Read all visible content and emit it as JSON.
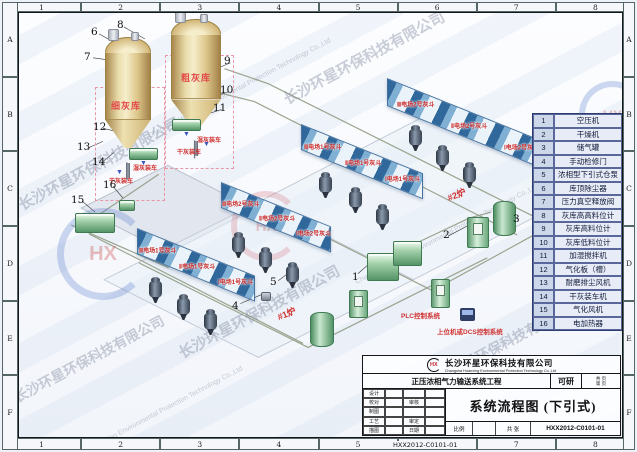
{
  "frame": {
    "top": [
      "1",
      "2",
      "3",
      "4",
      "5",
      "6",
      "7",
      "8"
    ],
    "bottom": [
      "1",
      "2",
      "3",
      "4",
      "5",
      "6",
      "7",
      "8"
    ],
    "left": [
      "A",
      "B",
      "C",
      "D",
      "E",
      "F"
    ],
    "right": [
      "A",
      "B",
      "C",
      "D",
      "E",
      "F"
    ]
  },
  "watermarks": {
    "company_cn": "长沙环星环保科技有限公司",
    "company_en": "Changsha Huanxing Environmental Protection Technology Co.,Ltd",
    "logo_text": "HX"
  },
  "plant": {
    "silo_fine": "细灰库",
    "silo_coarse": "粗灰库",
    "wet_loading": "湿灰装车",
    "dry_loading": "干灰装车",
    "boiler1": "#1炉",
    "boiler2": "#2炉",
    "plc": "PLC控制系统",
    "dcs": "上位机或DCS控制系统",
    "hopper_groups": [
      {
        "labels": [
          "Ⅲ电场2号灰斗",
          "Ⅱ电场2号灰斗",
          "Ⅰ电场2号灰斗"
        ]
      },
      {
        "labels": [
          "Ⅲ电场1号灰斗",
          "Ⅱ电场1号灰斗",
          "Ⅰ电场1号灰斗"
        ]
      },
      {
        "labels": [
          "Ⅲ电场2号灰斗",
          "Ⅱ电场2号灰斗",
          "Ⅰ电场2号灰斗"
        ]
      },
      {
        "labels": [
          "Ⅲ电场1号灰斗",
          "Ⅱ电场1号灰斗",
          "Ⅰ电场1号灰斗"
        ]
      }
    ],
    "callouts": [
      "1",
      "2",
      "3",
      "4",
      "5",
      "6",
      "7",
      "8",
      "9",
      "10",
      "11",
      "12",
      "13",
      "14",
      "15",
      "16"
    ]
  },
  "legend": {
    "rows": [
      {
        "no": "1",
        "name": "空压机"
      },
      {
        "no": "2",
        "name": "干燥机"
      },
      {
        "no": "3",
        "name": "储气罐"
      },
      {
        "no": "4",
        "name": "手动检修门"
      },
      {
        "no": "5",
        "name": "浓相型下引式仓泵"
      },
      {
        "no": "6",
        "name": "库顶除尘器"
      },
      {
        "no": "7",
        "name": "压力真空释放阀"
      },
      {
        "no": "8",
        "name": "灰库高高料位计"
      },
      {
        "no": "9",
        "name": "灰库高料位计"
      },
      {
        "no": "10",
        "name": "灰库低料位计"
      },
      {
        "no": "11",
        "name": "加湿搅拌机"
      },
      {
        "no": "12",
        "name": "气化板（槽）"
      },
      {
        "no": "13",
        "name": "耐磨排尘风机"
      },
      {
        "no": "14",
        "name": "干灰装车机"
      },
      {
        "no": "15",
        "name": "气化风机"
      },
      {
        "no": "16",
        "name": "电加热器"
      }
    ]
  },
  "title_block": {
    "logo_text": "HX",
    "company_cn": "长沙环星环保科技有限公司",
    "company_en": "Changsha Huanxing Environmental Protection Technology Co.,Ltd",
    "project": "正压浓相气力输送系统工程",
    "stage": "可研",
    "pages_line1": "共 页",
    "pages_line2": "第 页",
    "fields_left": [
      "设计",
      "校对",
      "制图",
      "工艺",
      "描图"
    ],
    "fields_mid": [
      "审核",
      "审定",
      "日期"
    ],
    "drawing_title": "系统流程图 (下引式)",
    "scale_label": "比例",
    "sheet_label": "共 张",
    "drawing_no": "HXX2012-C0101-01"
  }
}
